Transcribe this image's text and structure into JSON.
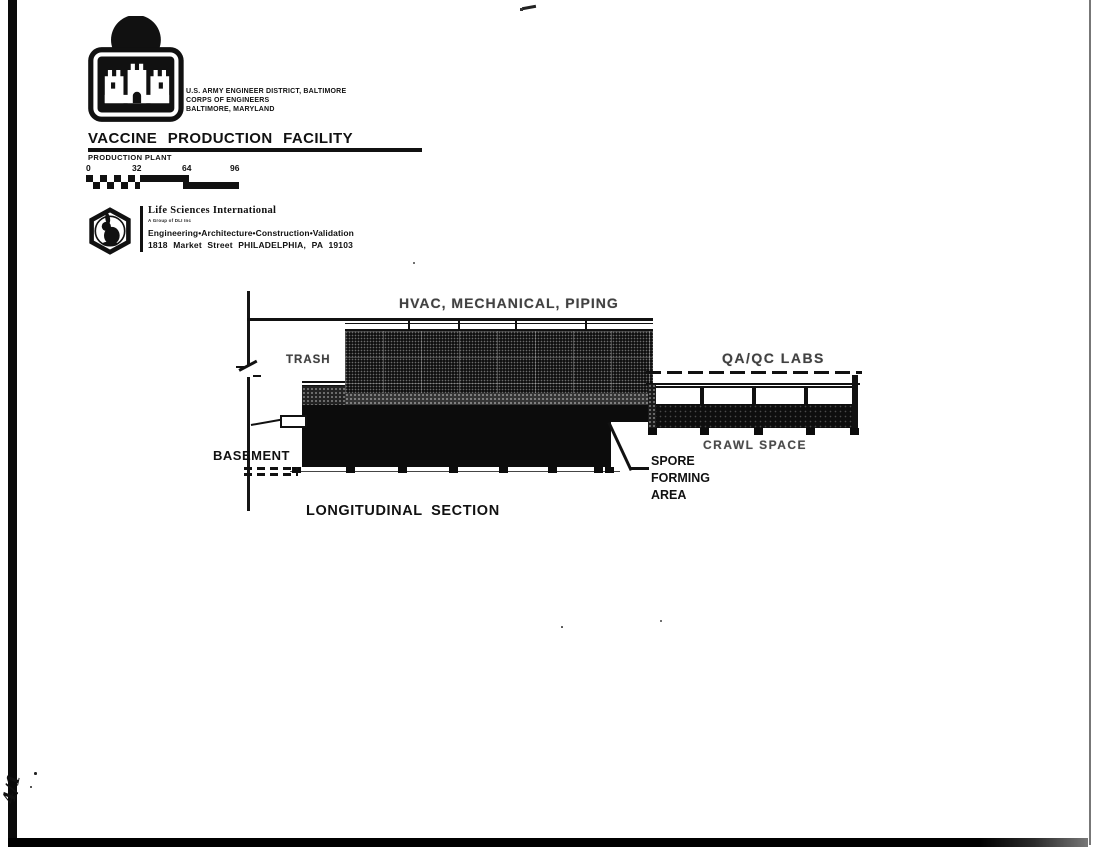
{
  "page": {
    "background": "#ffffff",
    "ink": "#111111"
  },
  "header": {
    "agency_lines": [
      "U.S. ARMY ENGINEER DISTRICT, BALTIMORE",
      "CORPS OF ENGINEERS",
      "BALTIMORE, MARYLAND"
    ],
    "title": "VACCINE PRODUCTION FACILITY",
    "subtitle": "PRODUCTION PLANT"
  },
  "scale_bar": {
    "ticks": [
      "0",
      "32",
      "64",
      "96"
    ]
  },
  "firm": {
    "name": "Life Sciences International",
    "small_print": "A Group of DLI Inc",
    "services": "Engineering•Architecture•Construction•Validation",
    "address": "1818 Market Street PHILADELPHIA, PA 19103"
  },
  "drawing": {
    "title": "LONGITUDINAL SECTION",
    "labels": {
      "hvac": "HVAC, MECHANICAL, PIPING",
      "trash": "TRASH",
      "qaqc": "QA/QC LABS",
      "crawl": "CRAWL SPACE",
      "spore": [
        "SPORE",
        "FORMING",
        "AREA"
      ],
      "basement": "BASEMENT"
    }
  },
  "annotations": {
    "handwritten_mark": "4/1"
  }
}
